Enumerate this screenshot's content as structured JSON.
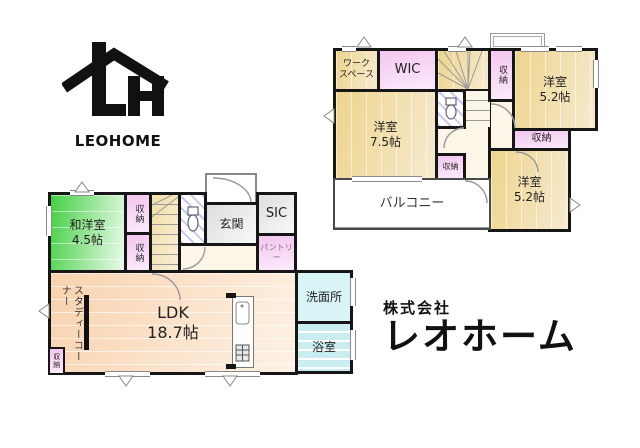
{
  "logo": {
    "brand": "LEOHOME"
  },
  "company": {
    "prefix": "株式会社",
    "name": "レオホーム"
  },
  "floor2": {
    "workspace": "ワーク\nスペース",
    "wic": "WIC",
    "closet_north": "収納",
    "bedroom_ne": "洋室\n5.2帖",
    "bedroom_west": "洋室\n7.5帖",
    "closet_hall": "収納",
    "closet_east": "収納",
    "bedroom_se": "洋室\n5.2帖",
    "balcony": "バルコニー"
  },
  "floor1": {
    "japanese_room": "和洋室\n4.5帖",
    "closet_upper": "収納",
    "closet_lower": "収納",
    "entrance": "玄関",
    "sic": "SIC",
    "pantry": "パントリー",
    "ldk": "LDK\n18.7帖",
    "study_corner": "スタディーコーナー",
    "closet_ldk": "収納",
    "washroom": "洗面所",
    "bathroom": "浴室"
  },
  "colors": {
    "wall": "#161616",
    "room_tan": "#eed48c",
    "closet_pink": "#f3c6ef",
    "tatami_green": "#44cf44",
    "ldk_peach": "#f8d2ae",
    "bath_cyan": "#c9edf1",
    "entrance_gray": "#dedede"
  }
}
